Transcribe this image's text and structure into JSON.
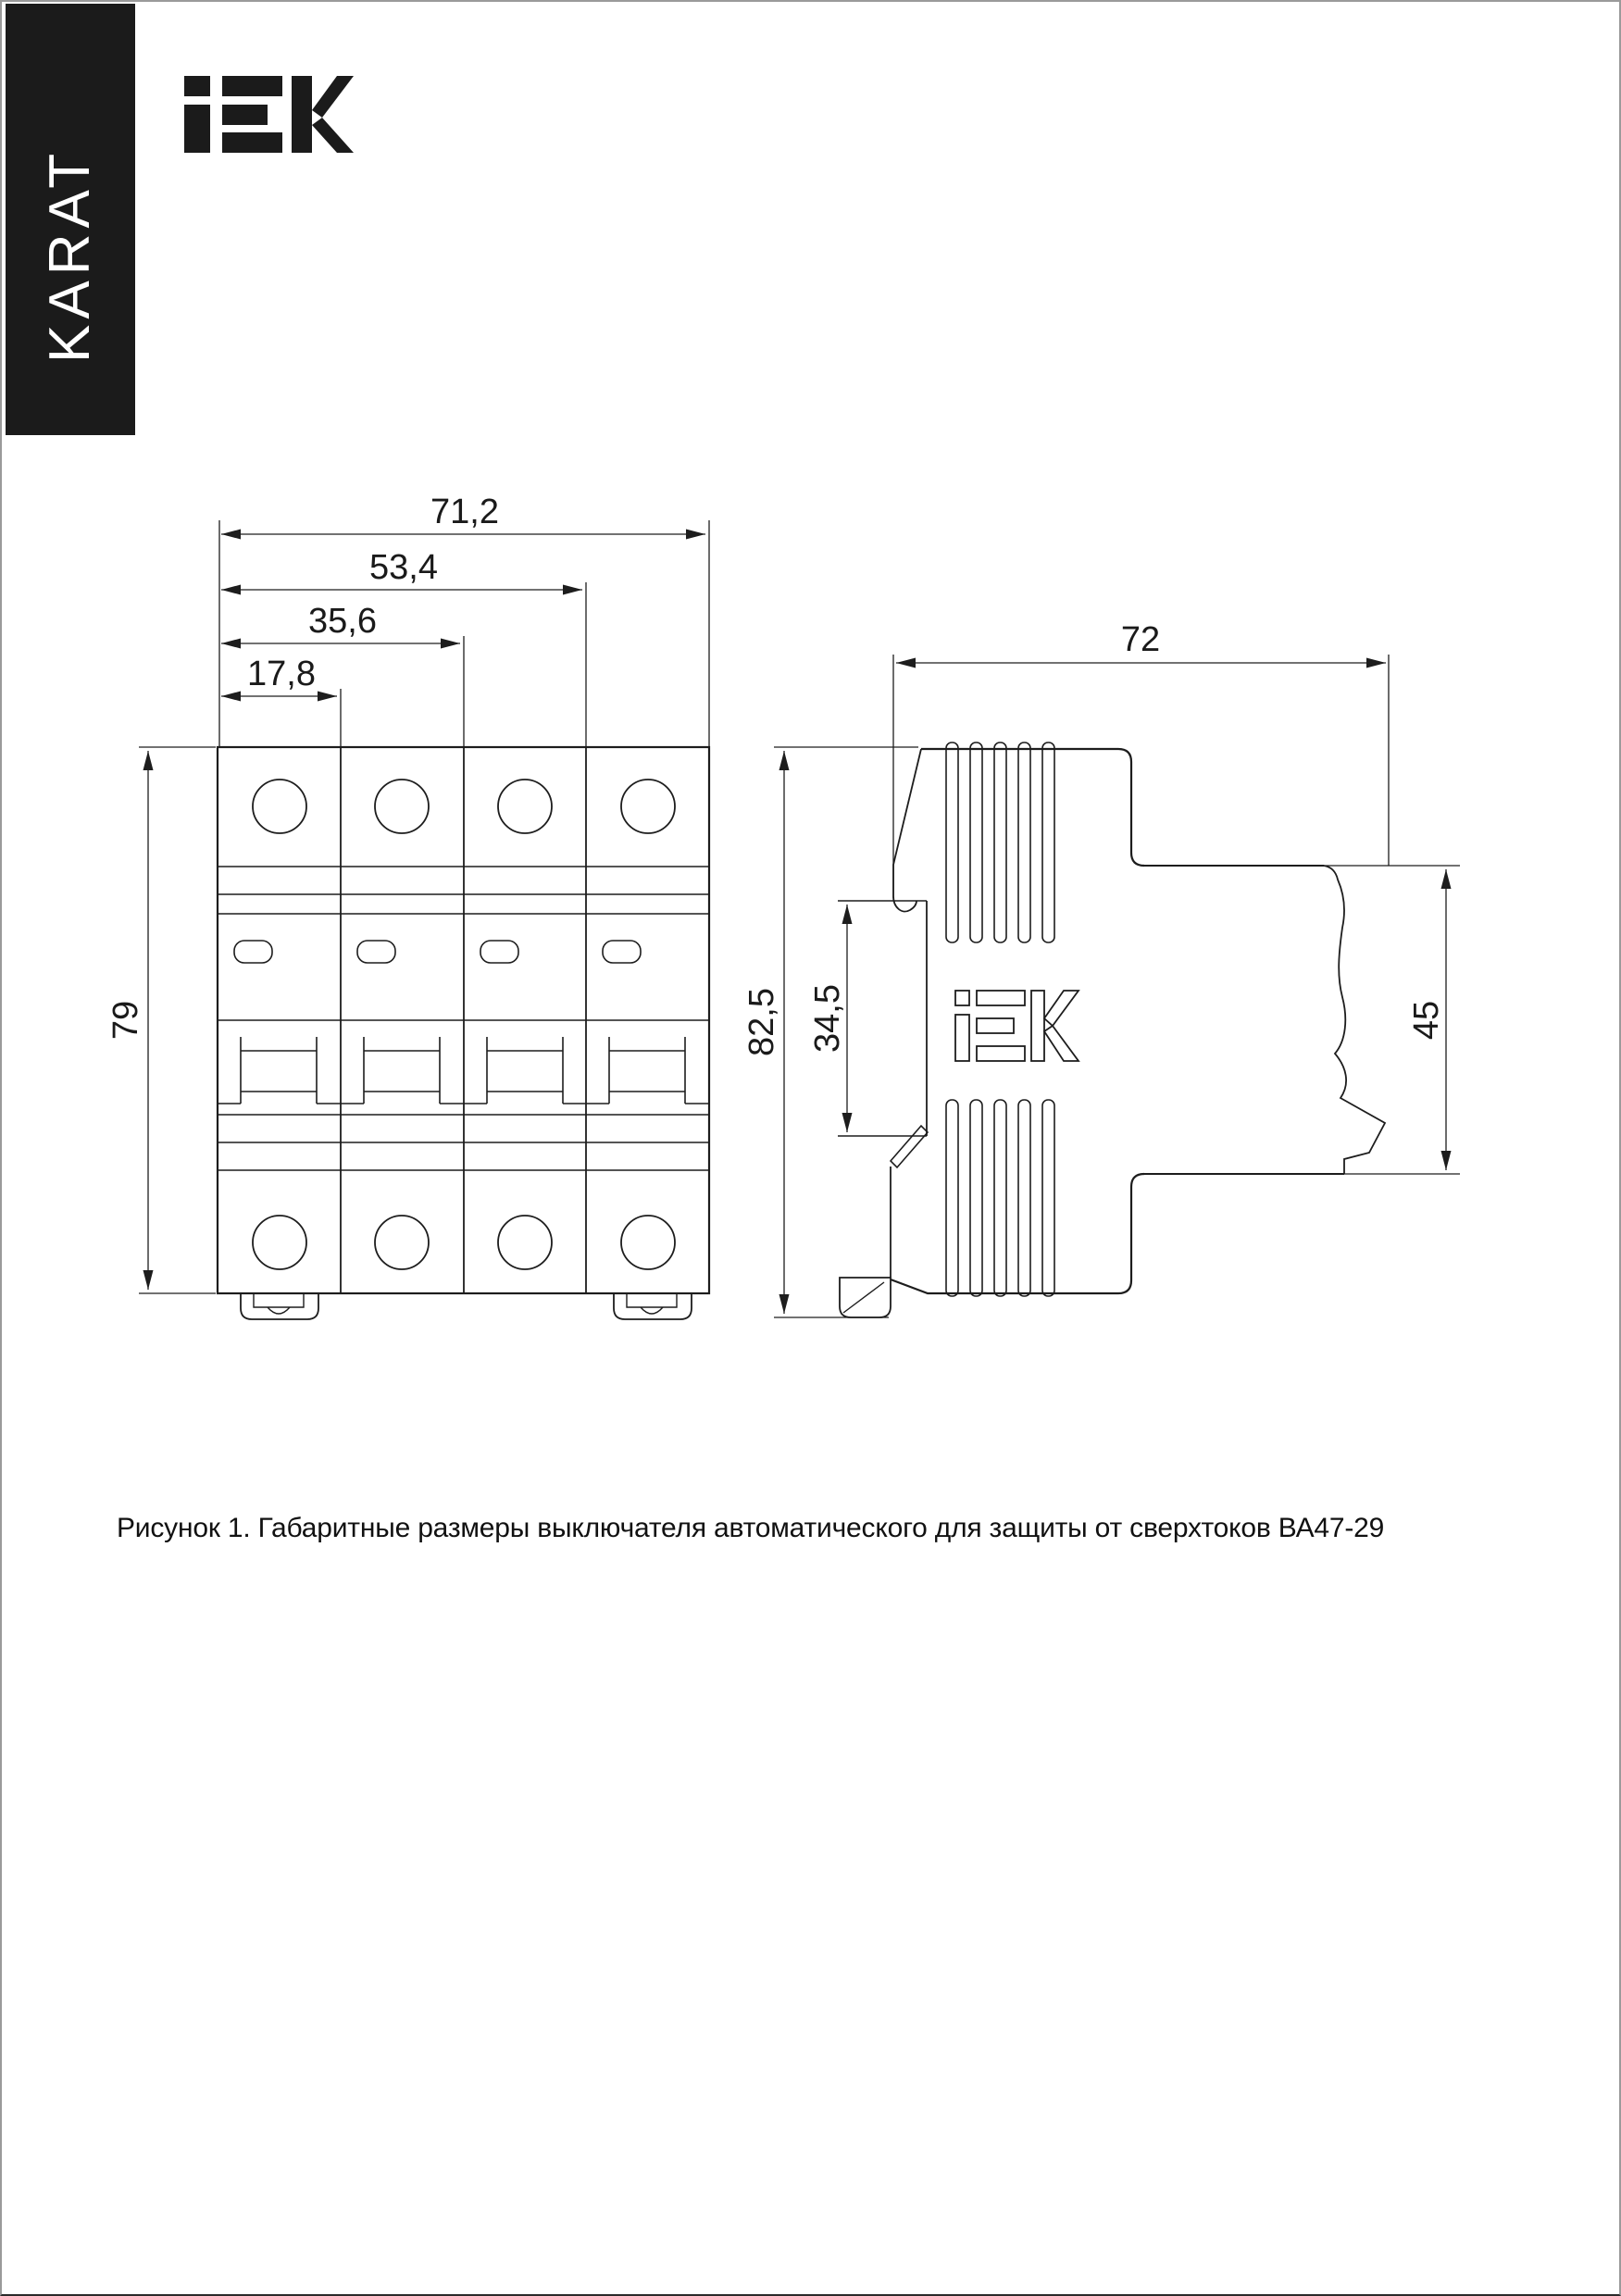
{
  "page": {
    "background": "#ffffff",
    "border_color": "#9a9a9a",
    "line_color": "#1d1d1d"
  },
  "banner": {
    "text": "KARAT",
    "bg": "#1b1b1b",
    "fg": "#ffffff"
  },
  "logo": {
    "text": "IEK"
  },
  "figure": {
    "caption": "Рисунок 1. Габаритные размеры выключателя автоматического для защиты от сверхтоков ВА47-29",
    "front_view": {
      "dims": {
        "width_total": "71,2",
        "width_three_pole": "53,4",
        "width_two_pole": "35,6",
        "width_one_pole": "17,8",
        "height": "79"
      }
    },
    "side_view": {
      "logo_text": "iEK",
      "dims": {
        "depth": "72",
        "height_total": "82,5",
        "din_channel": "34,5",
        "front_height": "45"
      }
    }
  }
}
